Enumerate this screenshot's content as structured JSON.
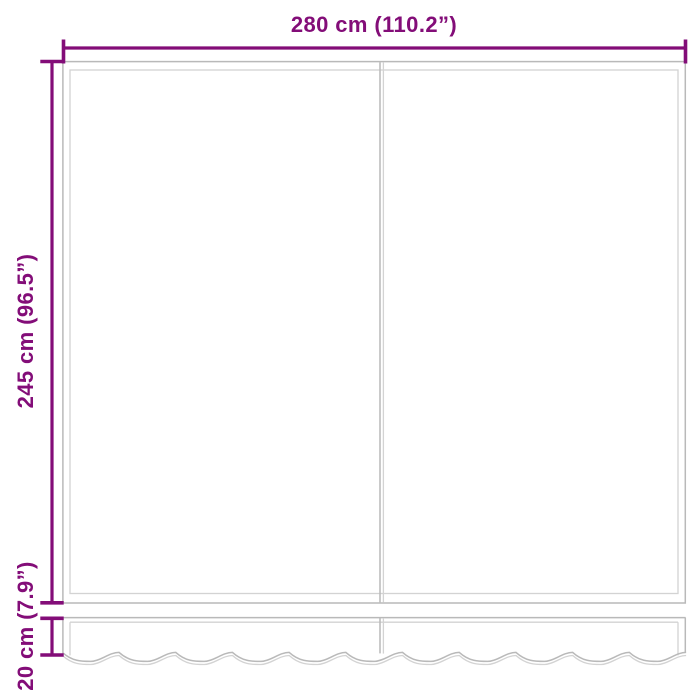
{
  "colors": {
    "background": "#ffffff",
    "dimension": "#830d78",
    "panel_line": "#b9b9b9",
    "panel_line_light": "#d3d3d3"
  },
  "labels": {
    "width": "280 cm (110.2”)",
    "height": "245 cm (96.5”)",
    "valance_height": "20 cm (7.9”)"
  }
}
